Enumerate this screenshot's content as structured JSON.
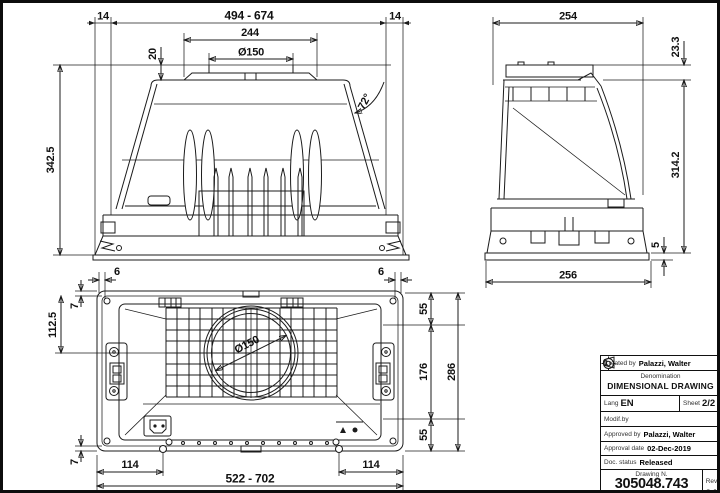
{
  "front": {
    "d14l": "14",
    "range": "494 - 674",
    "d14r": "14",
    "d244": "244",
    "d150": "Ø150",
    "d20": "20",
    "angle": "72°",
    "d3425": "342.5"
  },
  "side": {
    "d254": "254",
    "d233": "23.3",
    "d3142": "314.2",
    "d5": "5",
    "d256": "256"
  },
  "plan": {
    "d6l": "6",
    "d6r": "6",
    "d7t": "7",
    "d1125": "112.5",
    "d150": "Ø150",
    "d55t": "55",
    "d176": "176",
    "d55b": "55",
    "d286": "286",
    "d7b": "7",
    "d114l": "114",
    "d114r": "114",
    "range": "522 - 702"
  },
  "title_block": {
    "created_by_label": "Created by",
    "created_by": "Palazzi, Walter",
    "denomination_label": "Denomination",
    "denomination": "DIMENSIONAL DRAWING",
    "lang_label": "Lang",
    "lang": "EN",
    "sheet_label": "Sheet",
    "sheet": "2/2",
    "modif_label": "Modif.by",
    "approved_label": "Approved by",
    "approved_by": "Palazzi, Walter",
    "approval_date_label": "Approval date",
    "approval_date": "02-Dec-2019",
    "doc_status_label": "Doc. status",
    "doc_status": "Released",
    "drawing_n_label": "Drawing N.",
    "drawing_n": "305048.743",
    "rev_label": "Rev",
    "rev": "01"
  },
  "colors": {
    "line": "#1b1b1b",
    "background": "#ffffff"
  }
}
